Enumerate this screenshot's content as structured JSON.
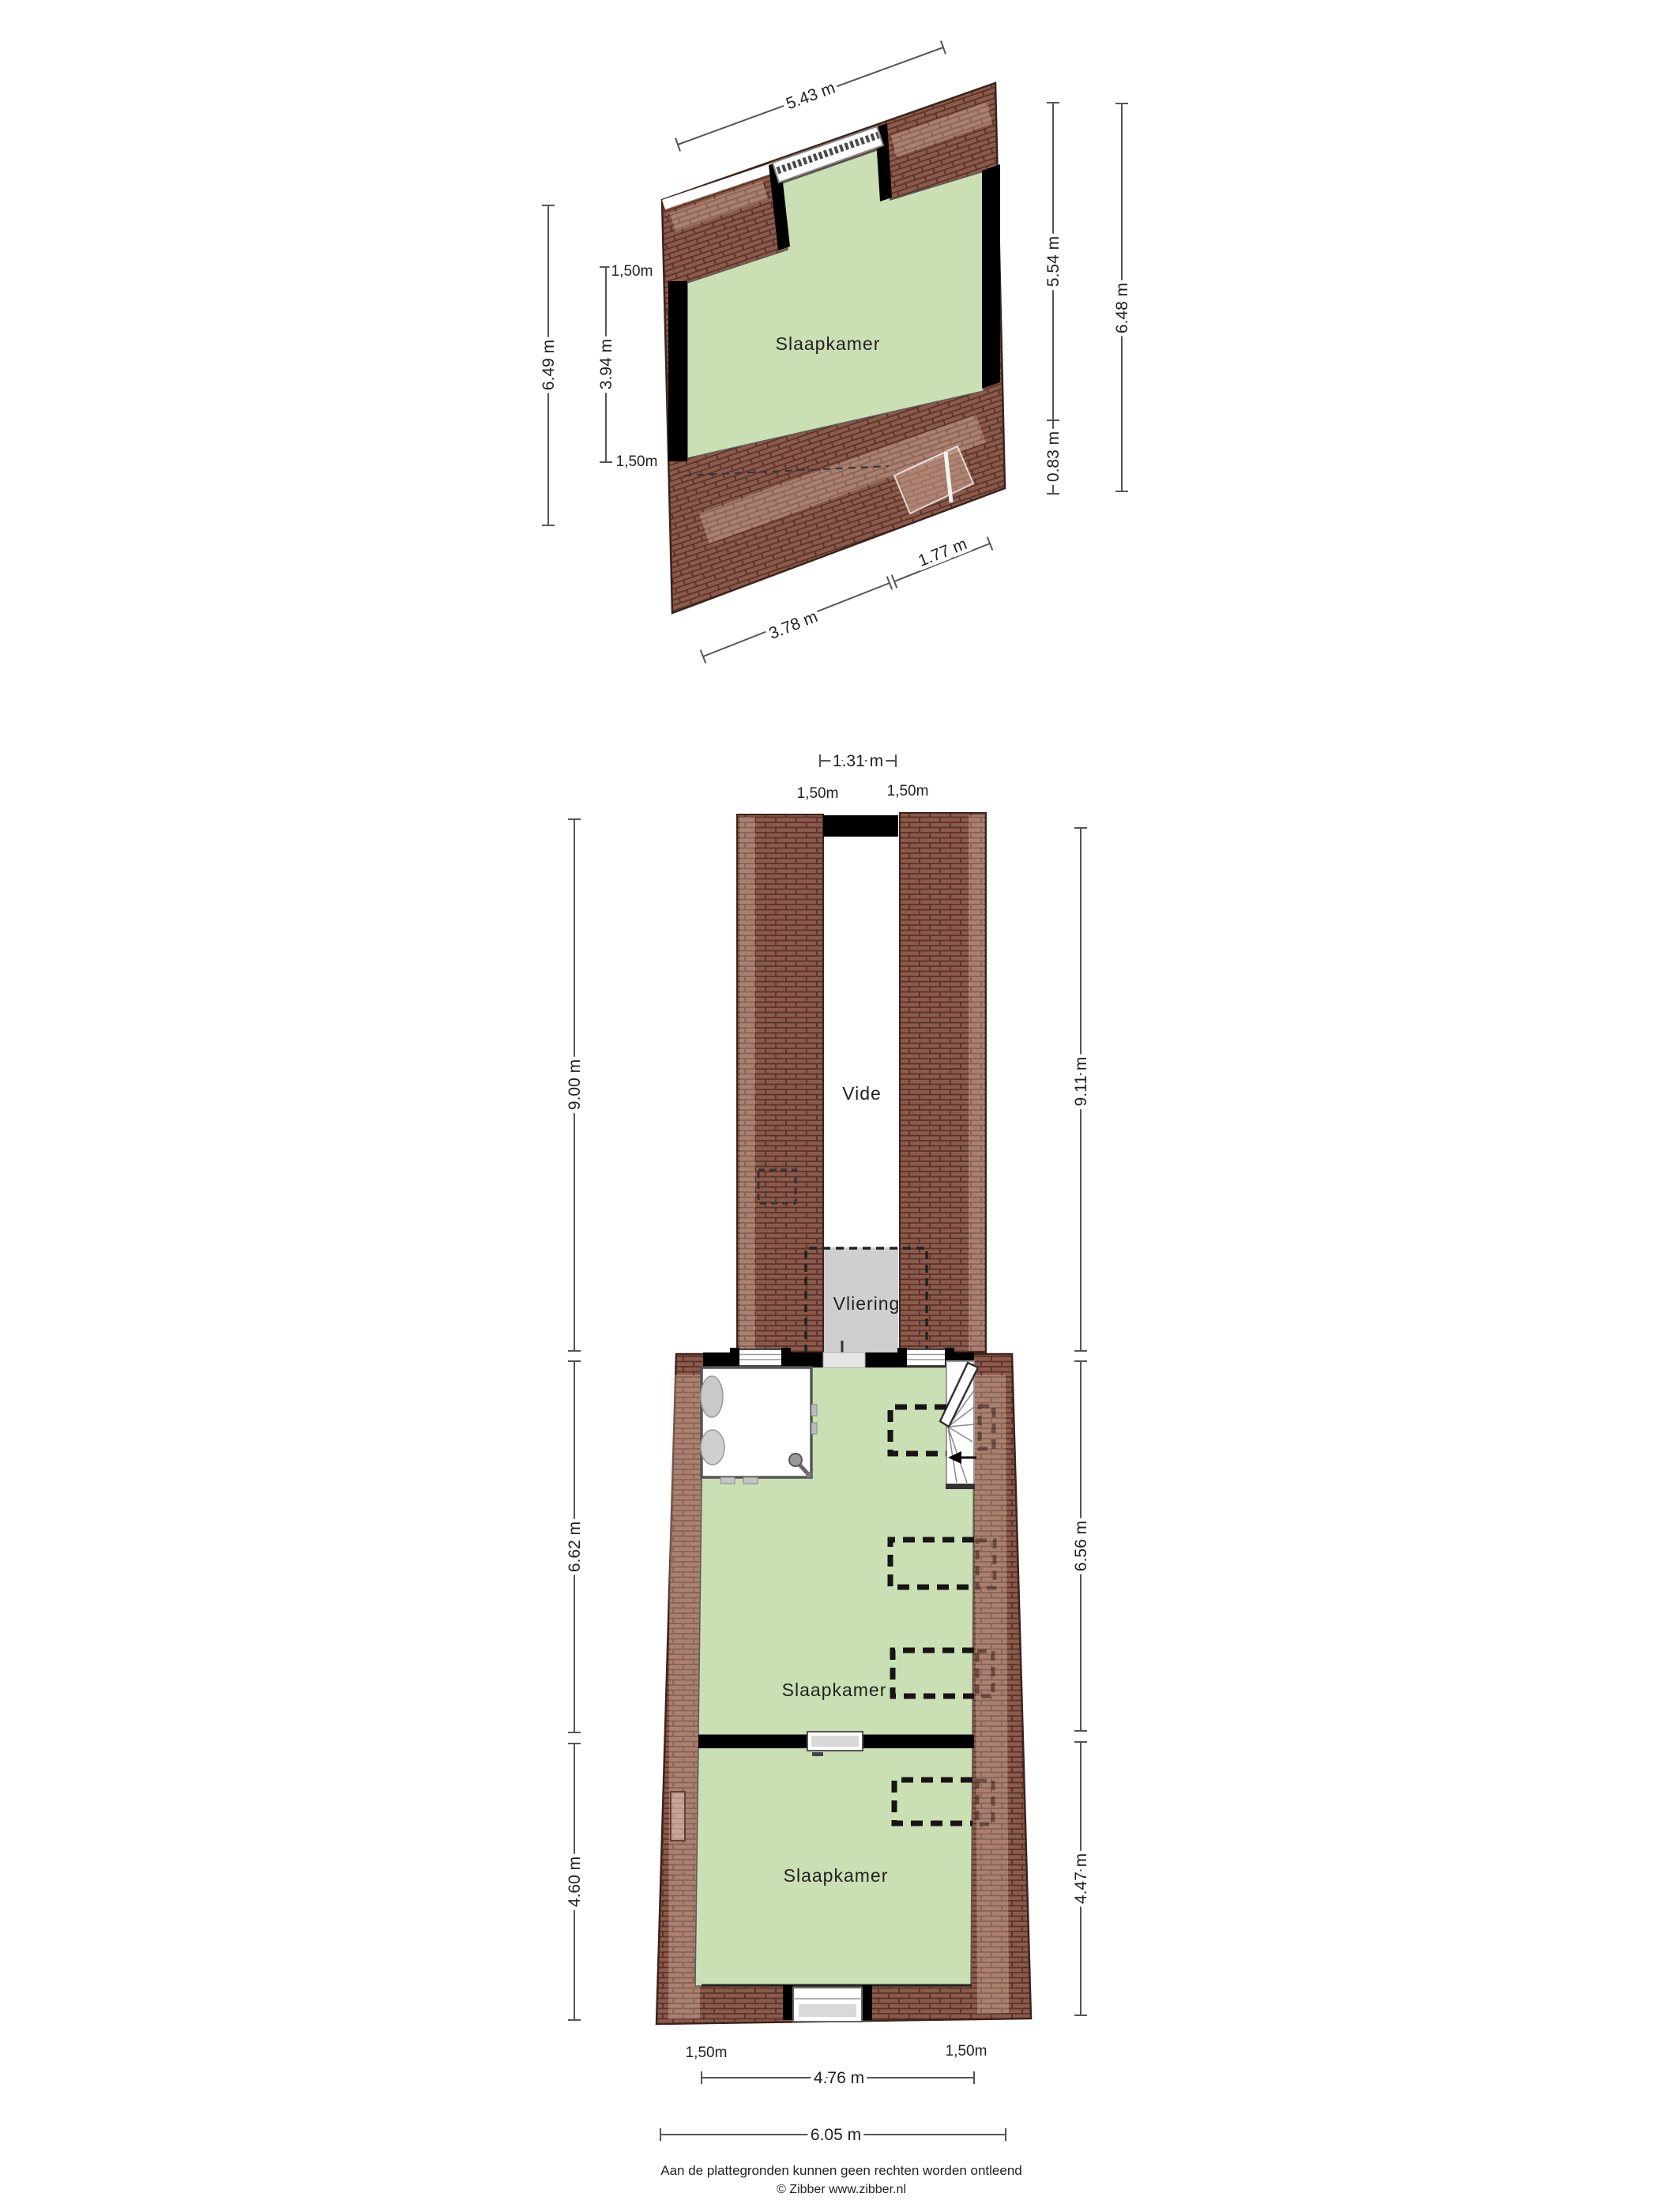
{
  "colors": {
    "room_green": "#cbdfb4",
    "roof_brown": "#8c5a4b",
    "roof_joint": "#573229",
    "wall_black": "#000000",
    "vliering_gray": "#cfcfcf",
    "dimension_line": "#555555",
    "text": "#222222"
  },
  "floor_top": {
    "room_label": "Slaapkamer",
    "dim_top": "5.43 m",
    "dim_left_outer": "6.49 m",
    "dim_left_inner": "3.94 m",
    "knee_left_top": "1,50m",
    "knee_left_bottom": "1,50m",
    "dim_right_inner_top": "5.54 m",
    "dim_right_inner_bottom": "0.83 m",
    "dim_right_outer": "6.48 m",
    "dim_bottom_left": "3.78 m",
    "dim_bottom_right": "1.77 m"
  },
  "floor_bottom": {
    "vide_label": "Vide",
    "vliering_label": "Vliering",
    "room_mid_label": "Slaapkamer",
    "room_low_label": "Slaapkamer",
    "dim_top_width": "1.31 m",
    "knee_top_left": "1,50m",
    "knee_top_right": "1,50m",
    "dim_left_top": "9.00 m",
    "dim_left_mid": "6.62 m",
    "dim_left_bottom": "4.60 m",
    "dim_right_top": "9.11 m",
    "dim_right_mid": "6.56 m",
    "dim_right_bottom": "4.47 m",
    "knee_bottom_left": "1,50m",
    "knee_bottom_right": "1,50m",
    "dim_bottom_inner": "4.76 m",
    "dim_bottom_outer": "6.05 m"
  },
  "footer": {
    "disclaimer": "Aan de plattegronden kunnen geen rechten worden ontleend",
    "copyright": "© Zibber www.zibber.nl"
  }
}
